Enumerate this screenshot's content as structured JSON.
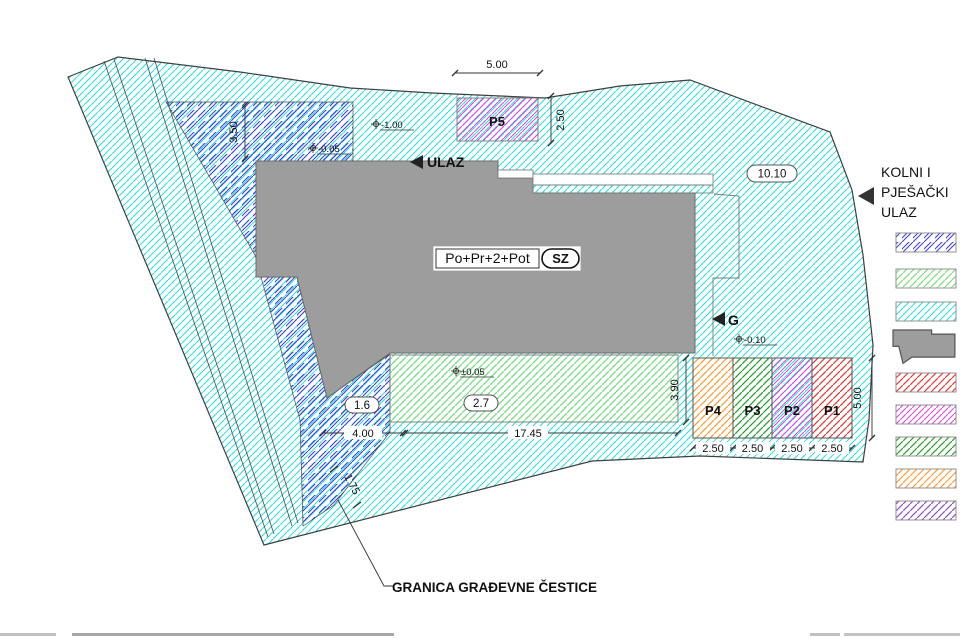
{
  "plan": {
    "boundary_label": "GRANICA  GRAĐEVNE ČESTICE",
    "building_label": "Po+Pr+2+Pot",
    "orientation_label": "SZ",
    "entrance_label": "ULAZ",
    "garage_label": "G",
    "width_label": "10.10",
    "terrace_label": "2.7",
    "strip_label": "1.6"
  },
  "levels": {
    "upper": "-1.00",
    "entry": "-0.05",
    "terrace": "±0.05",
    "parking": "-0.10"
  },
  "dims": {
    "p5_width": "5.00",
    "p5_depth": "2.50",
    "front": "3.50",
    "terrace_len": "17.45",
    "terrace_dep": "3.90",
    "notch": "4.00",
    "edge": "1.75",
    "stall_depth": "5.00"
  },
  "parking": {
    "p5": "P5",
    "stalls": [
      {
        "label": "P4",
        "width": "2.50"
      },
      {
        "label": "P3",
        "width": "2.50"
      },
      {
        "label": "P2",
        "width": "2.50"
      },
      {
        "label": "P1",
        "width": "2.50"
      }
    ]
  },
  "legend": {
    "access": [
      "KOLNI I",
      "PJEŠAČKI",
      "ULAZ"
    ],
    "swatches": [
      "violet-hatch",
      "green-hatch",
      "cyan-hatch",
      "building-footprint",
      "red-hatch",
      "magenta-hatch",
      "dark-green-hatch",
      "orange-hatch",
      "purple-hatch"
    ]
  },
  "colors": {
    "cyan": "#2fdede",
    "violet": "#4343cf",
    "light_green": "#7fdc7f",
    "magenta": "#da4ada",
    "red": "#e43b3b",
    "dark_green": "#2f9e2f",
    "orange": "#ff9e3c",
    "purple": "#8f4fc0",
    "building_gray": "#9d9d9d"
  }
}
